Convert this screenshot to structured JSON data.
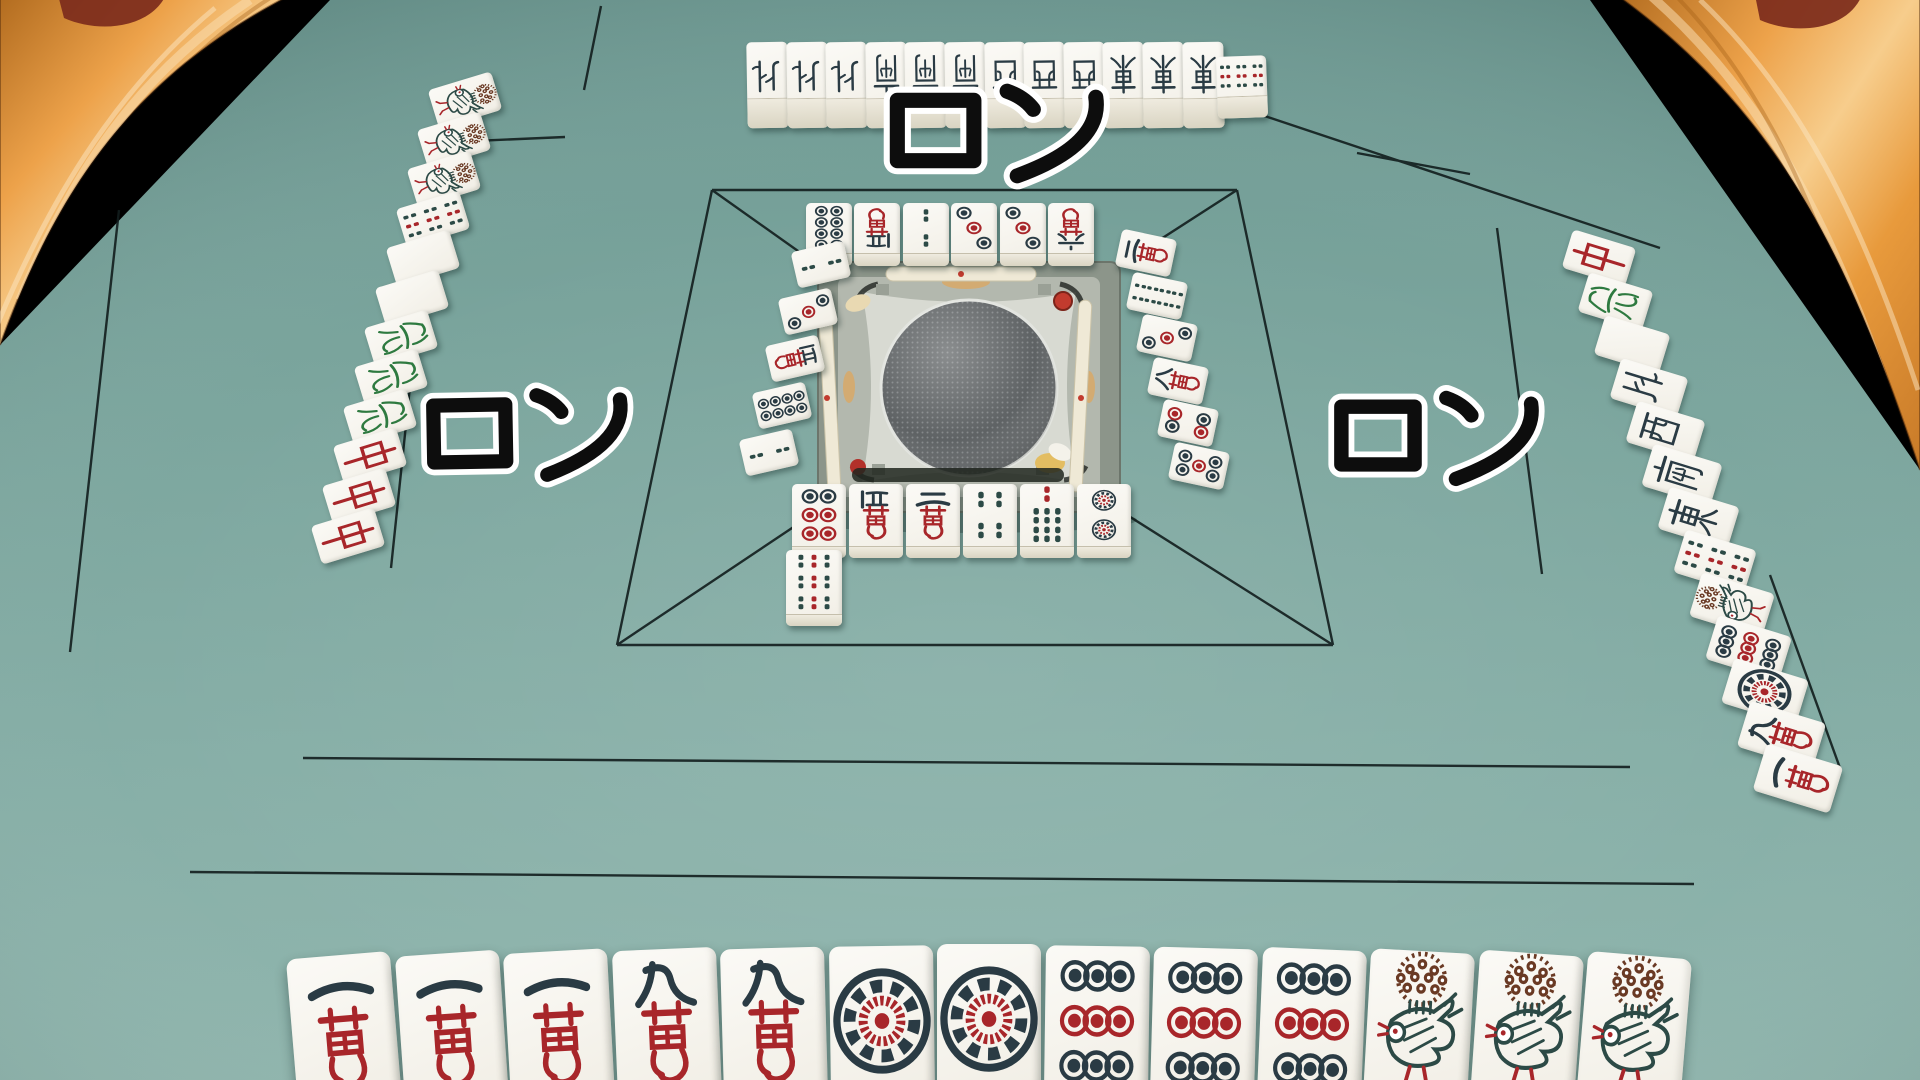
{
  "ron_calls": {
    "top": "ロン",
    "left": "ロン",
    "right": "ロン"
  },
  "players": {
    "top": {
      "revealed_hand": [
        "N",
        "N",
        "N",
        "S",
        "S",
        "S",
        "W",
        "W",
        "W",
        "E",
        "E",
        "E"
      ],
      "winning_tile": "9s",
      "discards": [
        "8p",
        "5m",
        "2s",
        "3p",
        "3p",
        "6m"
      ]
    },
    "left": {
      "revealed_hand": [
        "1s",
        "1s",
        "1s",
        "9s",
        "haku",
        "haku",
        "hatsu",
        "hatsu",
        "hatsu",
        "chun",
        "chun",
        "chun"
      ],
      "discards": [
        "2s",
        "3p",
        "5m",
        "8p",
        "2s"
      ]
    },
    "right": {
      "revealed_hand": [
        "chun",
        "hatsu",
        "haku",
        "N",
        "W",
        "S",
        "E",
        "9s",
        "1s",
        "9p",
        "1p",
        "9m",
        "1m"
      ],
      "discards": [
        "2m",
        "8s",
        "3p",
        "8m",
        "4p",
        "5p"
      ]
    },
    "bottom": {
      "hand": [
        "1m",
        "1m",
        "1m",
        "9m",
        "9m",
        "1p",
        "1p",
        "9p",
        "9p",
        "9p",
        "1s",
        "1s",
        "1s"
      ],
      "discards": [
        "6p",
        "5m",
        "2m",
        "4s",
        "7s",
        "2p"
      ],
      "last_discard": "9s"
    }
  },
  "tile_names": {
    "1m": "一萬",
    "2m": "二萬",
    "5m": "五萬",
    "6m": "六萬",
    "8m": "八萬",
    "9m": "九萬",
    "1p": "一筒",
    "2p": "二筒",
    "3p": "三筒",
    "4p": "四筒",
    "5p": "五筒",
    "6p": "六筒",
    "8p": "八筒",
    "9p": "九筒",
    "1s": "一索",
    "2s": "二索",
    "4s": "四索",
    "7s": "七索",
    "8s": "八索",
    "9s": "九索",
    "E": "東",
    "S": "南",
    "W": "西",
    "N": "北",
    "haku": "白",
    "hatsu": "發",
    "chun": "中"
  },
  "colors": {
    "felt": "#7aa49c",
    "line": "#121d1d",
    "tile_face": "#f7f5ef",
    "glyph_black": "#2a3b44",
    "glyph_red": "#a8262a",
    "glyph_green": "#2e7a40",
    "glyph_brown": "#6a3a24",
    "stick_teal": "#2c4a46",
    "arm_marble": "#eda74f",
    "arm_tip": "#7c2b1c",
    "machine_frame": "#8c958a",
    "machine_plate": "#d8dad2",
    "ron_fill": "#0d0d0d",
    "ron_outline": "#ffffff"
  }
}
